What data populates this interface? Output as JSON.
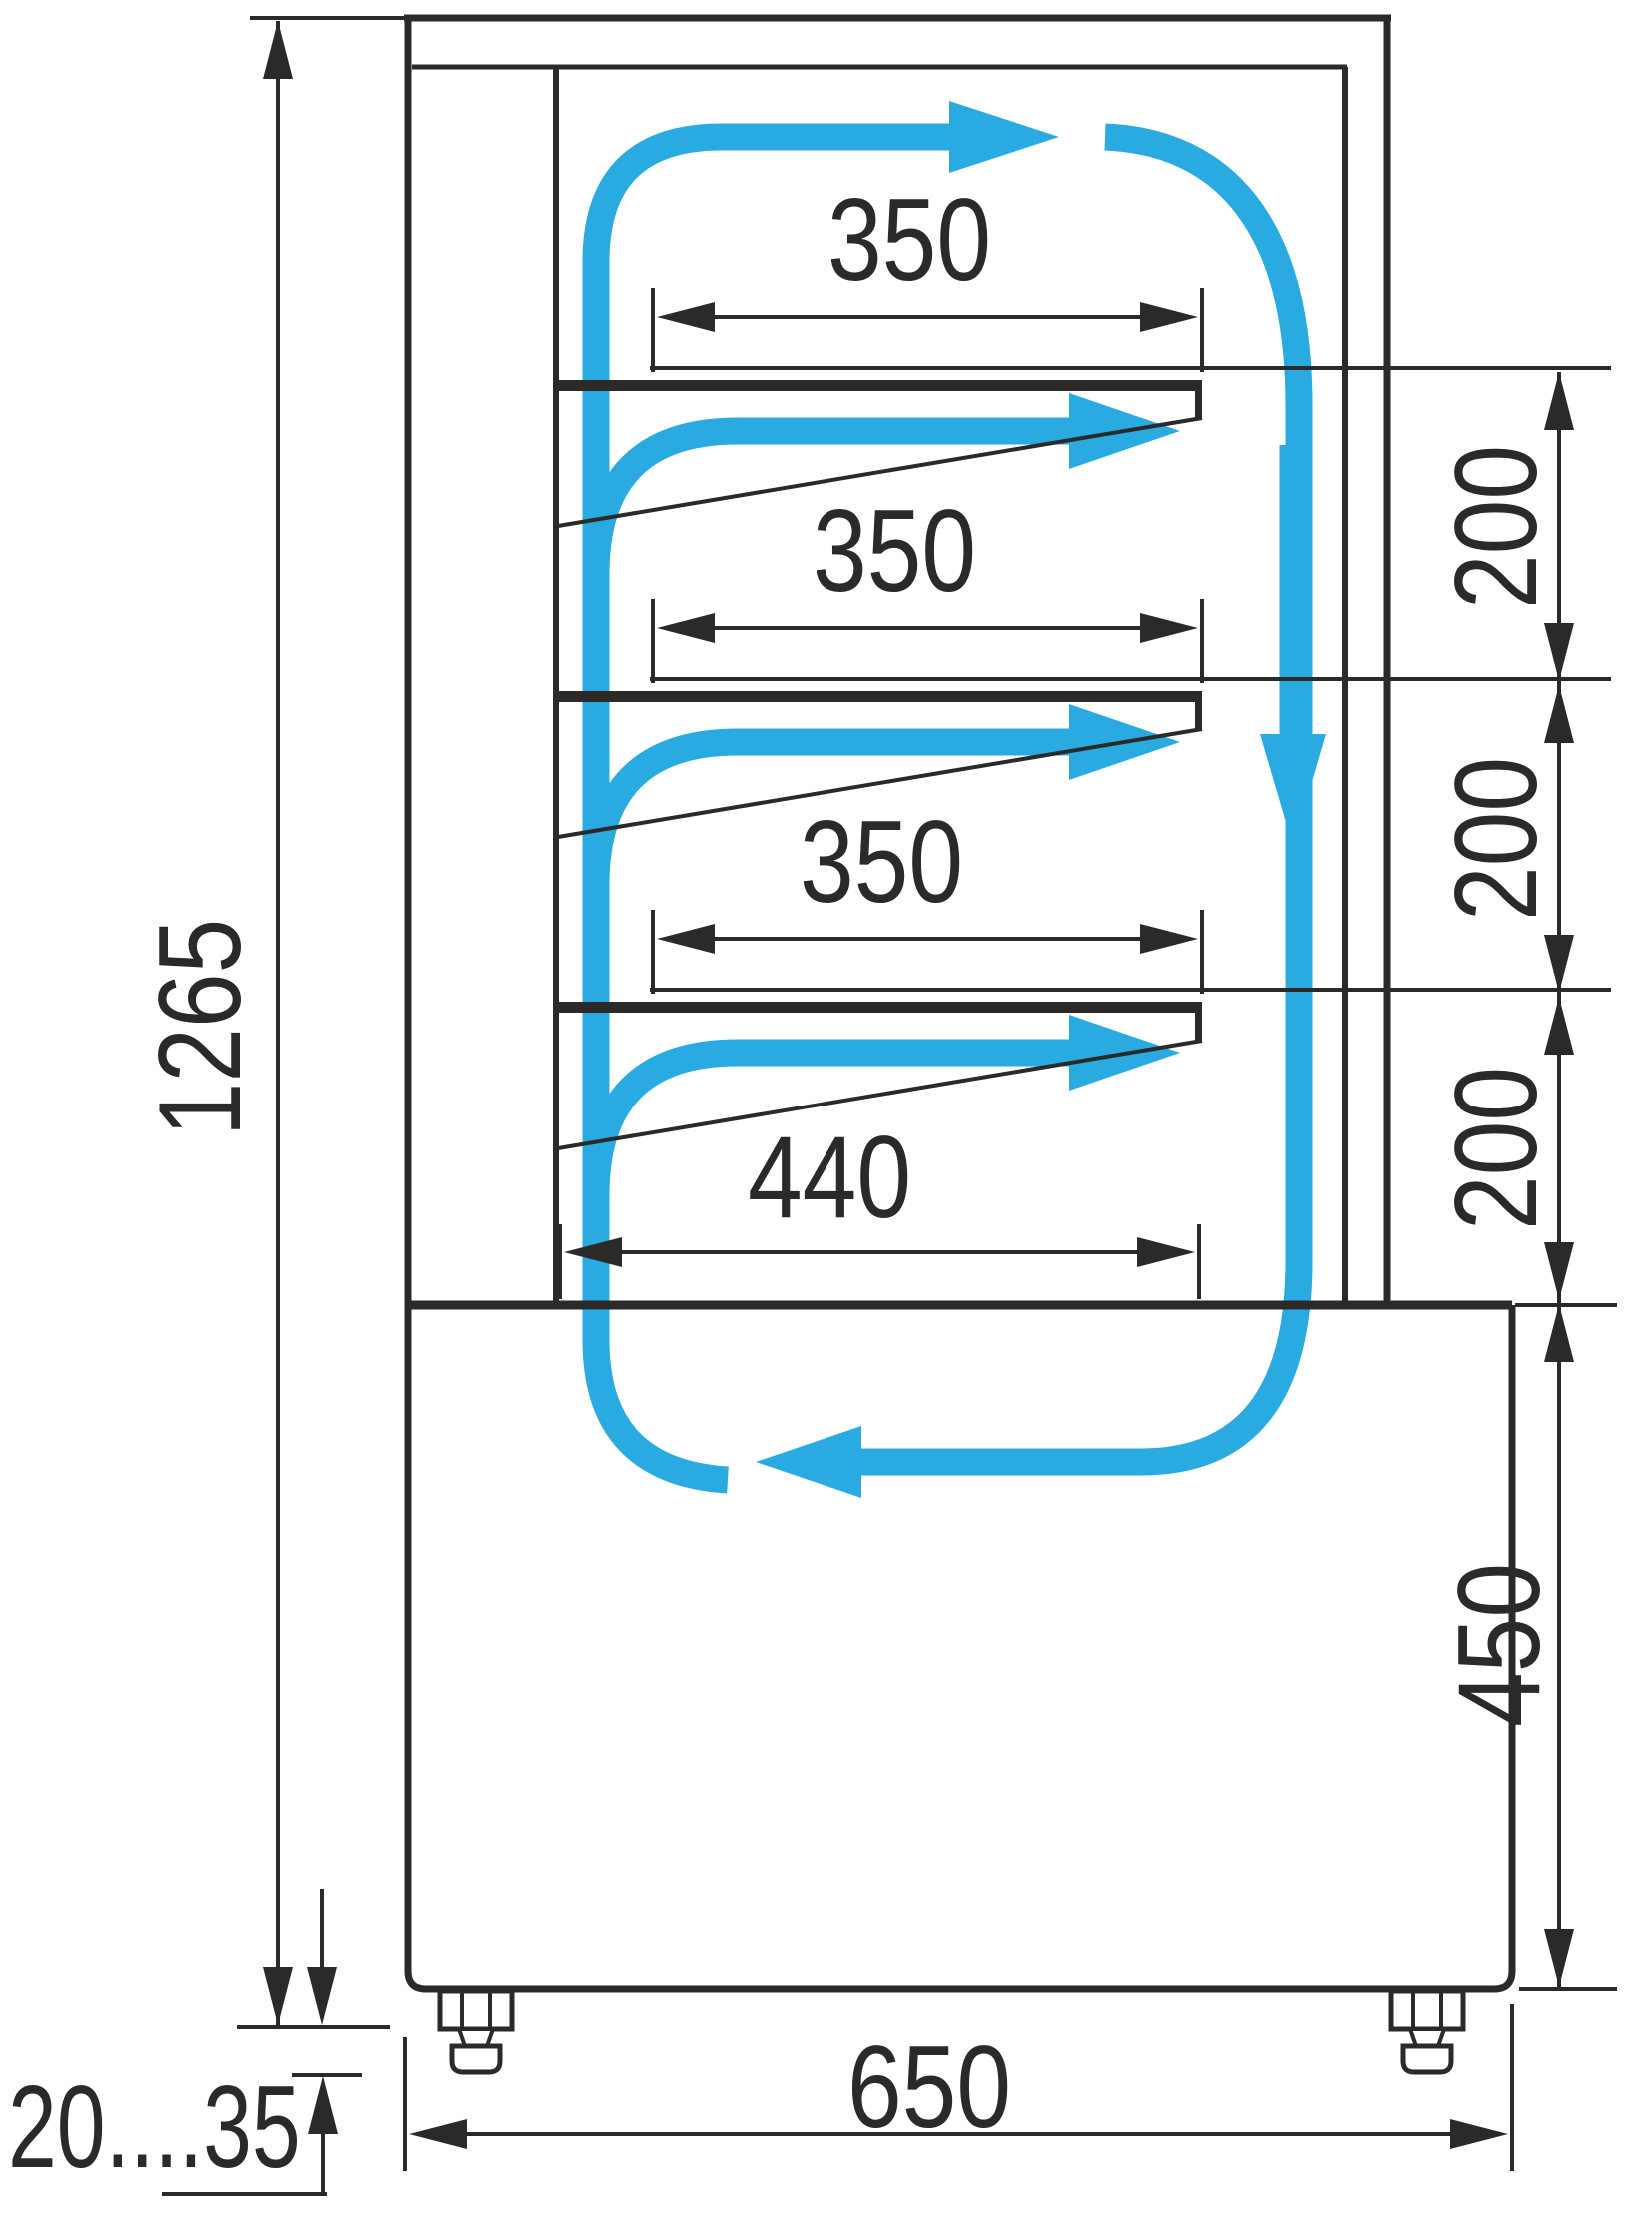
{
  "title": "Refrigerated confectionery display case — side section with airflow and dimensions",
  "colors": {
    "line": "#2b2a29",
    "airflow": "#29abe2",
    "background": "#ffffff"
  },
  "dimensions": {
    "shelf_widths_mm": [
      350,
      350,
      350
    ],
    "bottom_deck_width_mm": 440,
    "shelf_spacings_mm": [
      200,
      200,
      200
    ],
    "base_section_height_mm": 450,
    "overall_height_mm": 1265,
    "overall_depth_mm": 650,
    "foot_adjustment_range_mm": "20....35"
  },
  "labels": {
    "shelf_width_1": "350",
    "shelf_width_2": "350",
    "shelf_width_3": "350",
    "bottom_deck_width": "440",
    "gap_1": "200",
    "gap_2": "200",
    "gap_3": "200",
    "base_height": "450",
    "overall_height": "1265",
    "overall_depth": "650",
    "foot_range": "20....35"
  }
}
